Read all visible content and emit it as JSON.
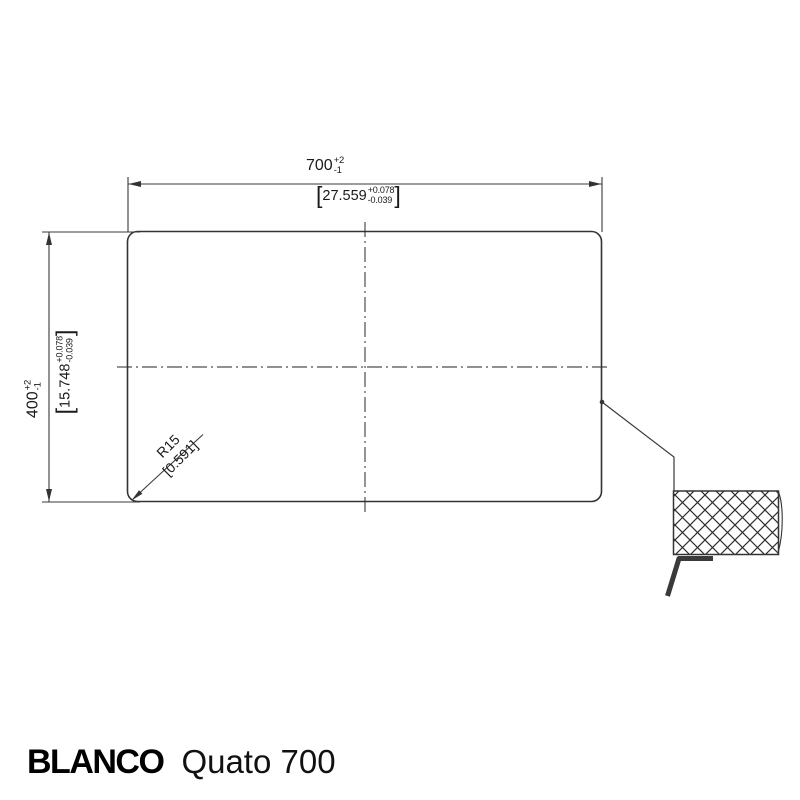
{
  "colors": {
    "outline": "#333333",
    "dimension_line": "#3a3a3a",
    "centerline": "#4d4d4d",
    "text": "#1a1a1a",
    "background": "#ffffff"
  },
  "dimensions": {
    "top": {
      "metric_value": "700",
      "metric_tol_plus": "+2",
      "metric_tol_minus": "-1",
      "imperial_open": "[",
      "imperial_value": "27.559",
      "imperial_tol_plus": "+0.078",
      "imperial_tol_minus": "-0.039",
      "imperial_close": "]"
    },
    "left": {
      "metric_value": "400",
      "metric_tol_plus": "+2",
      "metric_tol_minus": "-1",
      "imperial_open": "[",
      "imperial_value": "15.748",
      "imperial_tol_plus": "+0.078",
      "imperial_tol_minus": "-0.039",
      "imperial_close": "]"
    },
    "radius": {
      "label": "R15",
      "imperial": "[0.591]"
    }
  },
  "footer": {
    "brand": "BLANCO",
    "model": "Quato 700"
  }
}
